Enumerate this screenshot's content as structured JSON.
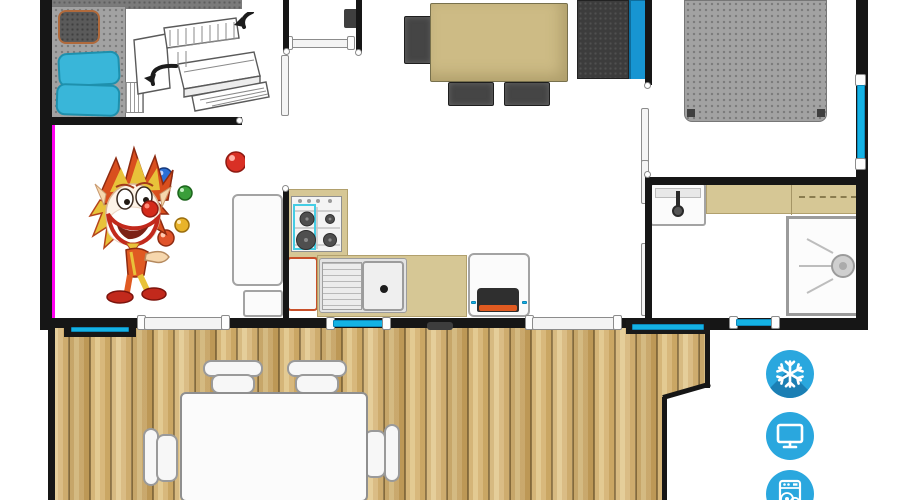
{
  "page": {
    "type": "floor-plan",
    "description": "Top-down mobile-home floor plan with furnished rooms, juggling clown illustration and wooden terrace"
  },
  "colors": {
    "wall_black": "#161616",
    "window_cyan": "#14b2e4",
    "furniture_tan": "#cdbb85",
    "counter_tan": "#d6c795",
    "deck_wood": "#d3b273",
    "bed_gray": "#a2a2a2",
    "sofa_blue": "#1795d2",
    "pillow_cyan": "#39b6d9",
    "amenity_blue": "#2aa7de",
    "amenity_shadow_blue": "#1b7fb4",
    "highlight_magenta": "#ff00f0"
  },
  "amenities": [
    {
      "icon": "snowflake-icon",
      "label": "air-conditioning"
    },
    {
      "icon": "tv-icon",
      "label": "television"
    },
    {
      "icon": "dishwasher-icon",
      "label": "dishwasher"
    }
  ],
  "illustrations": [
    {
      "name": "clown-illustration",
      "label": "juggling clown"
    },
    {
      "name": "bunk-bed-illustration",
      "label": "convertible bunk bed sketch with fold arrows"
    }
  ],
  "rooms": [
    {
      "name": "kids-bedroom",
      "items": [
        "single bed with cyan pillows",
        "bedside chair",
        "ladder",
        "bunk bed sketch"
      ]
    },
    {
      "name": "living-dining",
      "items": [
        "dining table",
        "three dark chairs",
        "sofa with blue backrest"
      ]
    },
    {
      "name": "master-bedroom",
      "items": [
        "double bed"
      ]
    },
    {
      "name": "bathroom",
      "items": [
        "washbasin",
        "counter",
        "shower cubicle"
      ]
    },
    {
      "name": "kitchen",
      "items": [
        "gas hob",
        "sink with drainboard",
        "fridge",
        "oven cabinet",
        "appliance"
      ]
    },
    {
      "name": "terrace",
      "items": [
        "wooden deck",
        "white table",
        "four white chairs"
      ]
    }
  ]
}
